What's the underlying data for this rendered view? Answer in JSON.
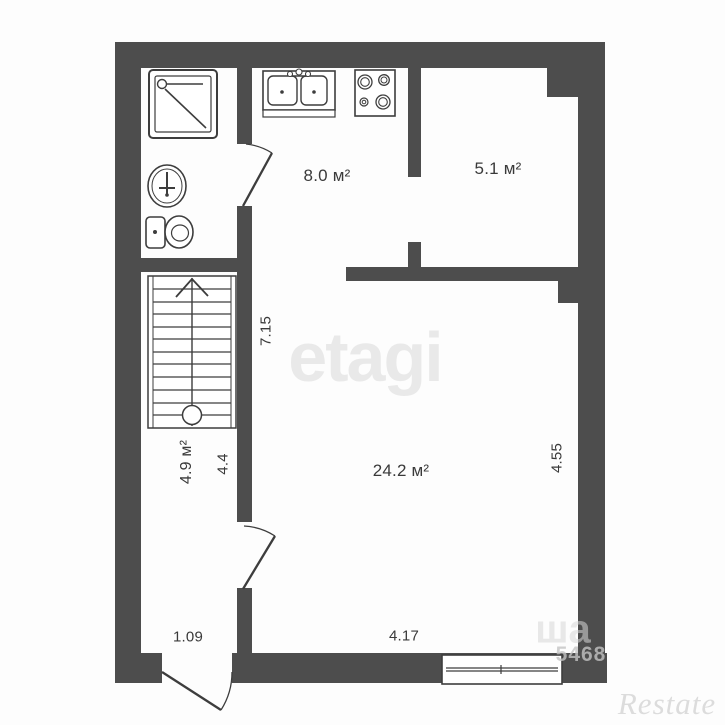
{
  "plan": {
    "rooms": {
      "kitchen": {
        "label": "8.0 м²"
      },
      "small_room": {
        "label": "5.1 м²"
      },
      "hall": {
        "label": "4.9 м²"
      },
      "living_room": {
        "label": "24.2 м²"
      }
    },
    "dimensions": {
      "left_height": "7.15",
      "hall_width": "4.4",
      "living_right_height": "4.55",
      "hall_bottom_width": "1.09",
      "living_bottom_width": "4.17"
    },
    "fixtures": [
      "shower",
      "washbasin",
      "toilet",
      "kitchen-sink",
      "stove",
      "staircase-up",
      "entrance-door",
      "interior-doors",
      "window"
    ]
  },
  "watermarks": {
    "center_brand": "etagi",
    "corner_brand": "Restate",
    "phone_fragment": "5468",
    "text_fragment": "ша"
  },
  "colors": {
    "wall": "#4d4d4d",
    "line": "#3d3d3d",
    "text": "#3a3a3a",
    "watermark_light": "#e9e9e9"
  }
}
